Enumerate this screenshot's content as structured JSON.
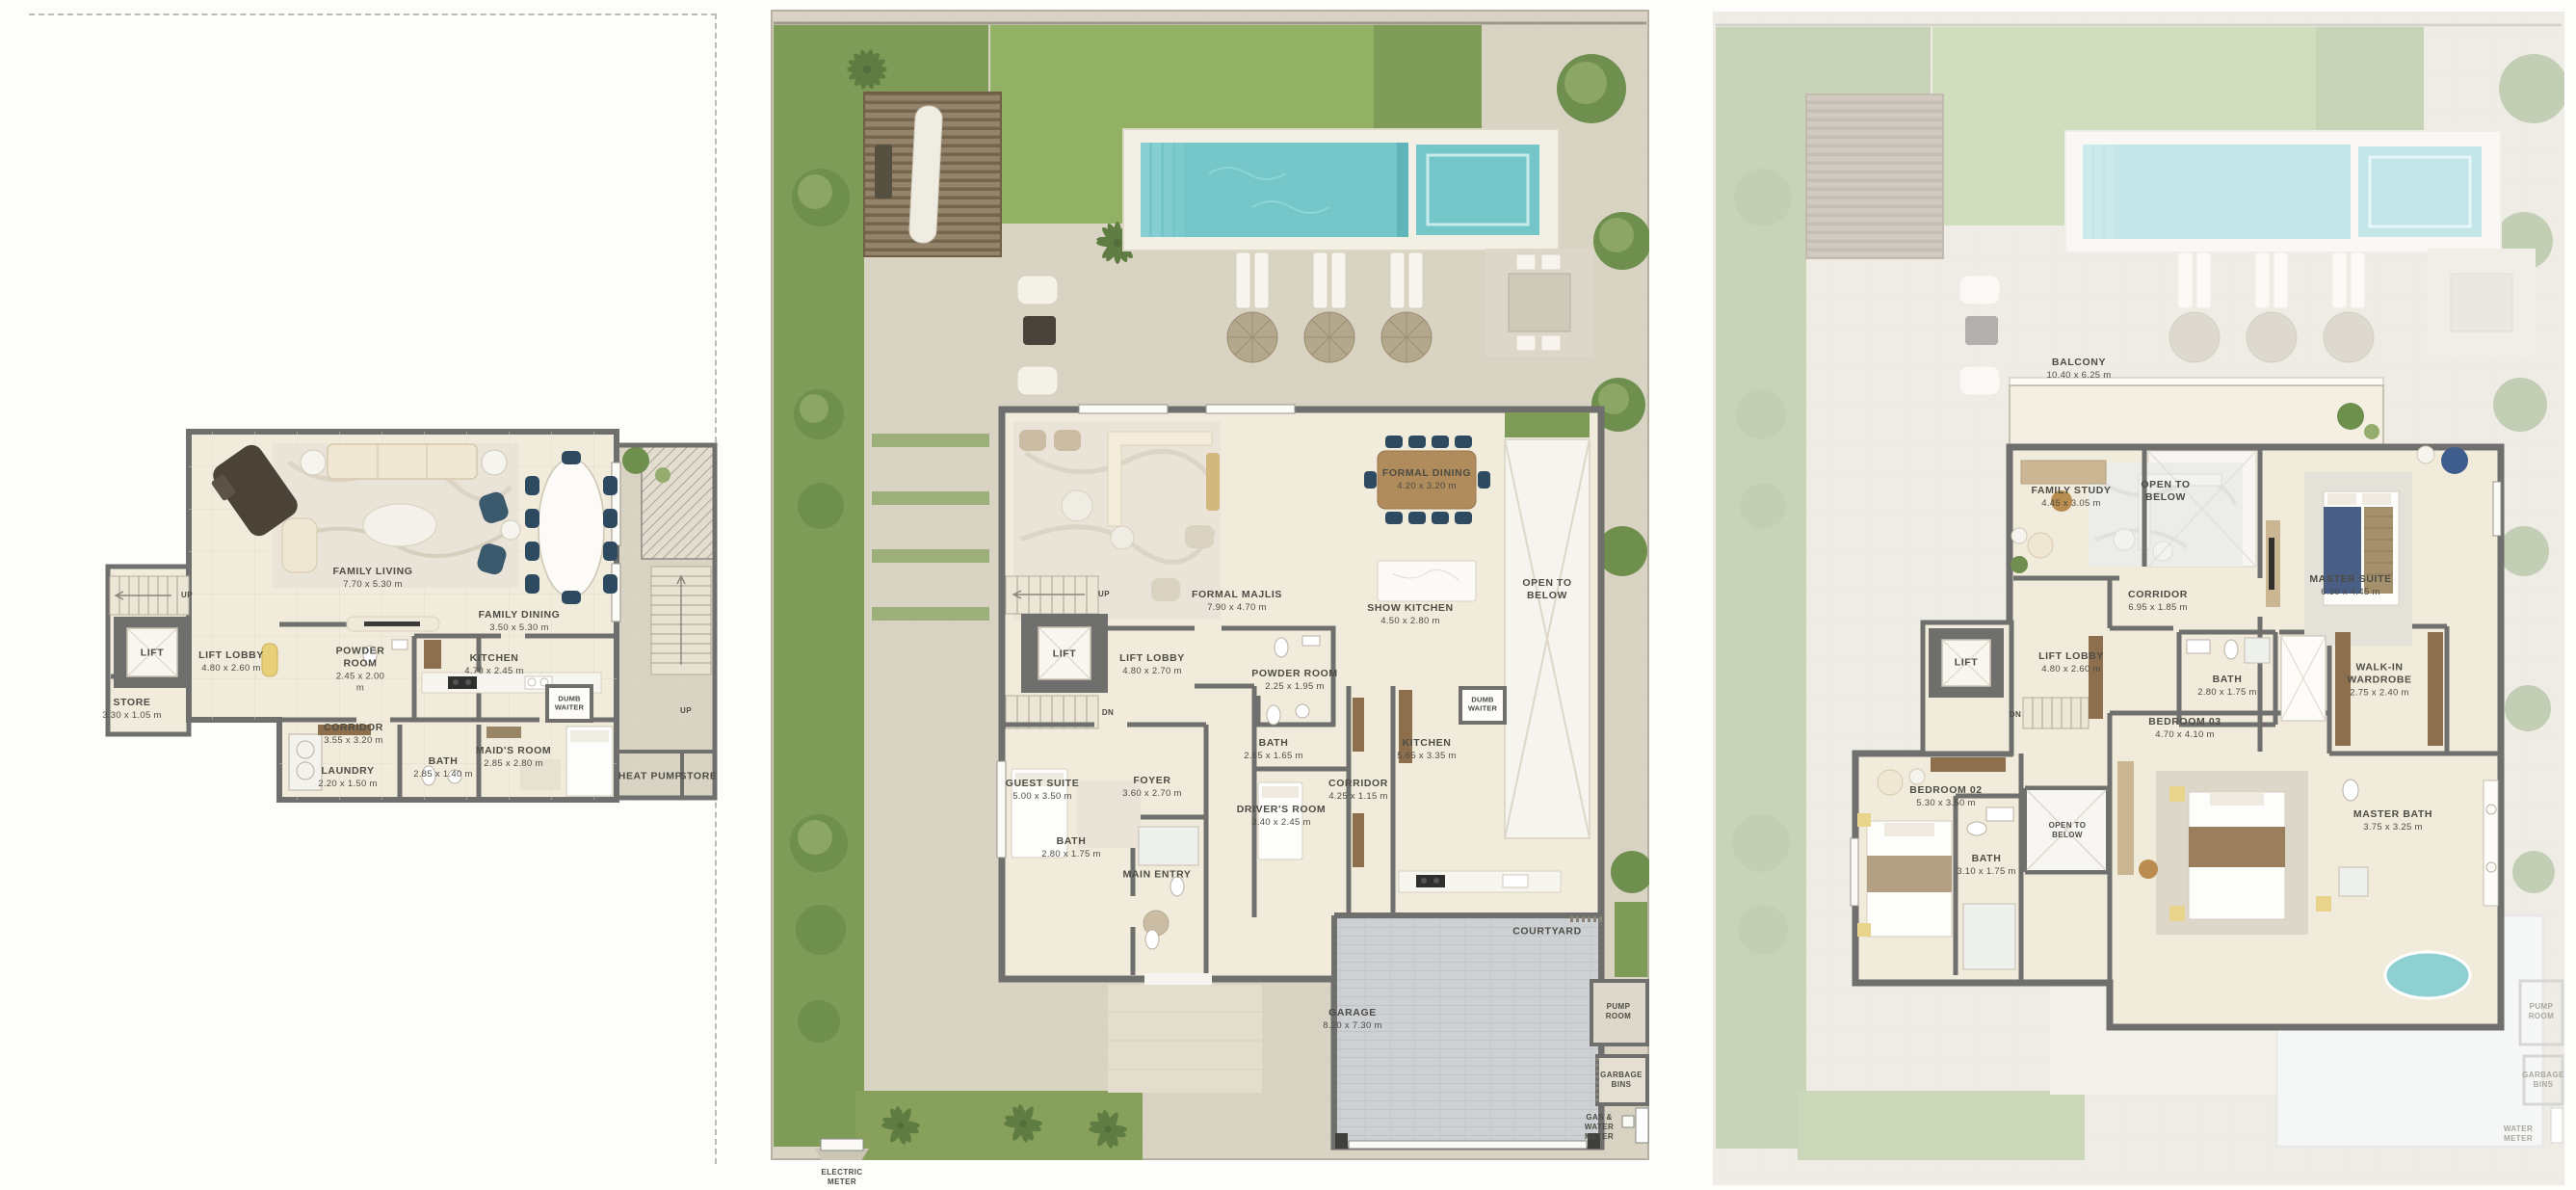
{
  "palette": {
    "wall": "#6f6f6d",
    "cream": "#f1ebdc",
    "paving": "#d9d3c3",
    "deck": "#f2efe5",
    "pool": "#74c6c9",
    "poolLight": "#8ad0d3",
    "grass": "#93b164",
    "hedge": "#7e9b58",
    "tree": "#6f8f4e",
    "treeLight": "#94ad6e",
    "wood": "#b08b5b",
    "woodDark": "#8d6f4e",
    "garage": "#ced1d3",
    "navy": "#2e4a60",
    "rug": "#e9e4d7",
    "text": "#4d4c45",
    "textGhost": "#a8a89f",
    "frame": "#b5b0a2",
    "white": "#fbfaf6"
  },
  "plans": {
    "left": {
      "rooms": {
        "familyLiving": {
          "name": "FAMILY LIVING",
          "dims": "7.70 x 5.30 m"
        },
        "familyDining": {
          "name": "FAMILY DINING",
          "dims": "3.50 x 5.30 m"
        },
        "lift": {
          "name": "LIFT",
          "dims": ""
        },
        "liftLobby": {
          "name": "LIFT LOBBY",
          "dims": "4.80 x 2.60 m"
        },
        "powderRoom": {
          "name": "POWDER ROOM",
          "dims": "2.45 x 2.00 m"
        },
        "kitchen": {
          "name": "KITCHEN",
          "dims": "4.70 x 2.45 m"
        },
        "store1": {
          "name": "STORE",
          "dims": "3.30 x 1.05 m"
        },
        "dumbWaiter": {
          "name": "DUMB WAITER",
          "dims": ""
        },
        "corridor": {
          "name": "CORRIDOR",
          "dims": "3.55 x 3.20 m"
        },
        "laundry": {
          "name": "LAUNDRY",
          "dims": "2.20 x 1.50 m"
        },
        "bath": {
          "name": "BATH",
          "dims": "2.85 x 1.40 m"
        },
        "maidsRoom": {
          "name": "MAID'S ROOM",
          "dims": "2.85 x 2.80 m"
        },
        "heatPump": {
          "name": "HEAT PUMP",
          "dims": ""
        },
        "store2": {
          "name": "STORE",
          "dims": ""
        },
        "up1": {
          "name": "UP",
          "dims": ""
        },
        "up2": {
          "name": "UP",
          "dims": ""
        }
      }
    },
    "ground": {
      "rooms": {
        "formalMajlis": {
          "name": "FORMAL MAJLIS",
          "dims": "7.90 x 4.70 m"
        },
        "formalDining": {
          "name": "FORMAL DINING",
          "dims": "4.20 x 3.20 m"
        },
        "showKitchen": {
          "name": "SHOW KITCHEN",
          "dims": "4.50 x 2.80 m"
        },
        "openToBelow": {
          "name": "OPEN TO BELOW",
          "dims": ""
        },
        "up": {
          "name": "UP",
          "dims": ""
        },
        "dn": {
          "name": "DN",
          "dims": ""
        },
        "lift": {
          "name": "LIFT",
          "dims": ""
        },
        "liftLobby": {
          "name": "LIFT LOBBY",
          "dims": "4.80 x 2.70 m"
        },
        "powderRoom": {
          "name": "POWDER ROOM",
          "dims": "2.25 x 1.95 m"
        },
        "guestSuite": {
          "name": "GUEST SUITE",
          "dims": "5.00 x 3.50 m"
        },
        "guestBath": {
          "name": "BATH",
          "dims": "2.80 x 1.75 m"
        },
        "foyer": {
          "name": "FOYER",
          "dims": "3.60 x 2.70 m"
        },
        "bath2": {
          "name": "BATH",
          "dims": "2.65 x 1.65 m"
        },
        "driversRoom": {
          "name": "DRIVER'S ROOM",
          "dims": "3.40 x 2.45 m"
        },
        "corridor": {
          "name": "CORRIDOR",
          "dims": "4.25 x 1.15 m"
        },
        "kitchen": {
          "name": "KITCHEN",
          "dims": "5.65 x 3.35 m"
        },
        "dumbWaiter": {
          "name": "DUMB WAITER",
          "dims": ""
        },
        "mainEntry": {
          "name": "MAIN ENTRY",
          "dims": ""
        },
        "garage": {
          "name": "GARAGE",
          "dims": "8.20 x 7.30 m"
        },
        "courtyard": {
          "name": "COURTYARD",
          "dims": ""
        },
        "pumpRoom": {
          "name": "PUMP ROOM",
          "dims": ""
        },
        "garbageBins": {
          "name": "GARBAGE BINS",
          "dims": ""
        },
        "gasWaterMeter": {
          "name": "GAS & WATER METER",
          "dims": ""
        },
        "electricMeter": {
          "name": "ELECTRIC METER",
          "dims": ""
        }
      }
    },
    "first": {
      "rooms": {
        "balcony": {
          "name": "BALCONY",
          "dims": "10.40 x 6.25 m"
        },
        "familyStudy": {
          "name": "FAMILY STUDY",
          "dims": "4.45 x 3.05 m"
        },
        "openToBelow1": {
          "name": "OPEN TO BELOW",
          "dims": ""
        },
        "masterSuite": {
          "name": "MASTER SUITE",
          "dims": "6.30 x 4.45 m"
        },
        "corridor": {
          "name": "CORRIDOR",
          "dims": "6.95 x 1.85 m"
        },
        "lift": {
          "name": "LIFT",
          "dims": ""
        },
        "dn": {
          "name": "DN",
          "dims": ""
        },
        "liftLobby": {
          "name": "LIFT LOBBY",
          "dims": "4.80 x 2.60 m"
        },
        "bath1": {
          "name": "BATH",
          "dims": "2.80 x 1.75 m"
        },
        "walkInWardrobe": {
          "name": "WALK-IN WARDROBE",
          "dims": "2.75 x 2.40 m"
        },
        "bedroom03": {
          "name": "BEDROOM 03",
          "dims": "4.70 x 4.10 m"
        },
        "bedroom02": {
          "name": "BEDROOM 02",
          "dims": "5.30 x 3.50 m"
        },
        "bath2": {
          "name": "BATH",
          "dims": "3.10 x 1.75 m"
        },
        "openToBelow2": {
          "name": "OPEN TO BELOW",
          "dims": ""
        },
        "masterBath": {
          "name": "MASTER BATH",
          "dims": "3.75 x 3.25 m"
        },
        "pumpRoom": {
          "name": "PUMP ROOM",
          "dims": ""
        },
        "garbageBins": {
          "name": "GARBAGE BINS",
          "dims": ""
        },
        "waterMeter": {
          "name": "WATER METER",
          "dims": ""
        }
      }
    }
  }
}
